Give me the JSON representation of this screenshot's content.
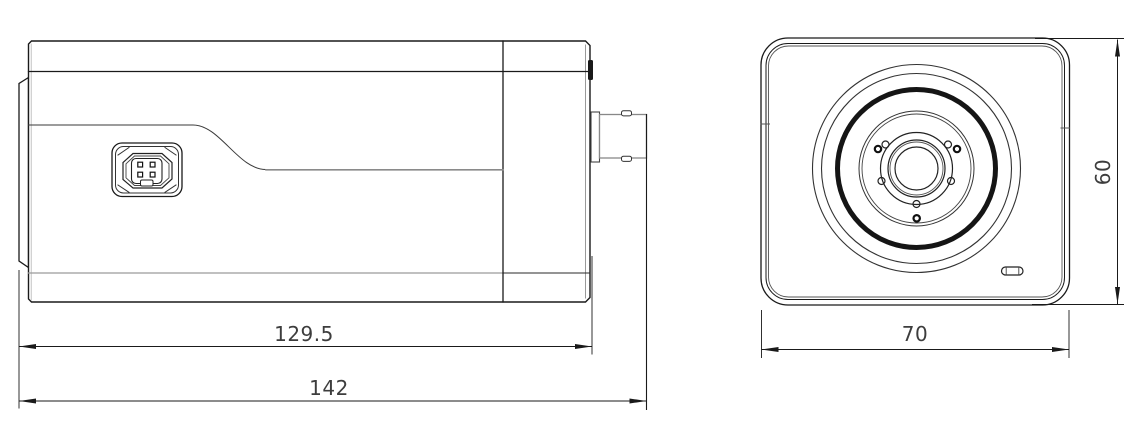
{
  "drawing": {
    "type": "technical-dimension-drawing",
    "subject": "box camera - side view and front view"
  },
  "dimensions": {
    "side_body_length": "129.5",
    "side_total_length": "142",
    "front_width": "70",
    "front_height": "60"
  },
  "colors": {
    "line": "#1a1a1a",
    "line_light": "#919191",
    "dim_text": "#3d3d3d",
    "background": "#ffffff"
  }
}
